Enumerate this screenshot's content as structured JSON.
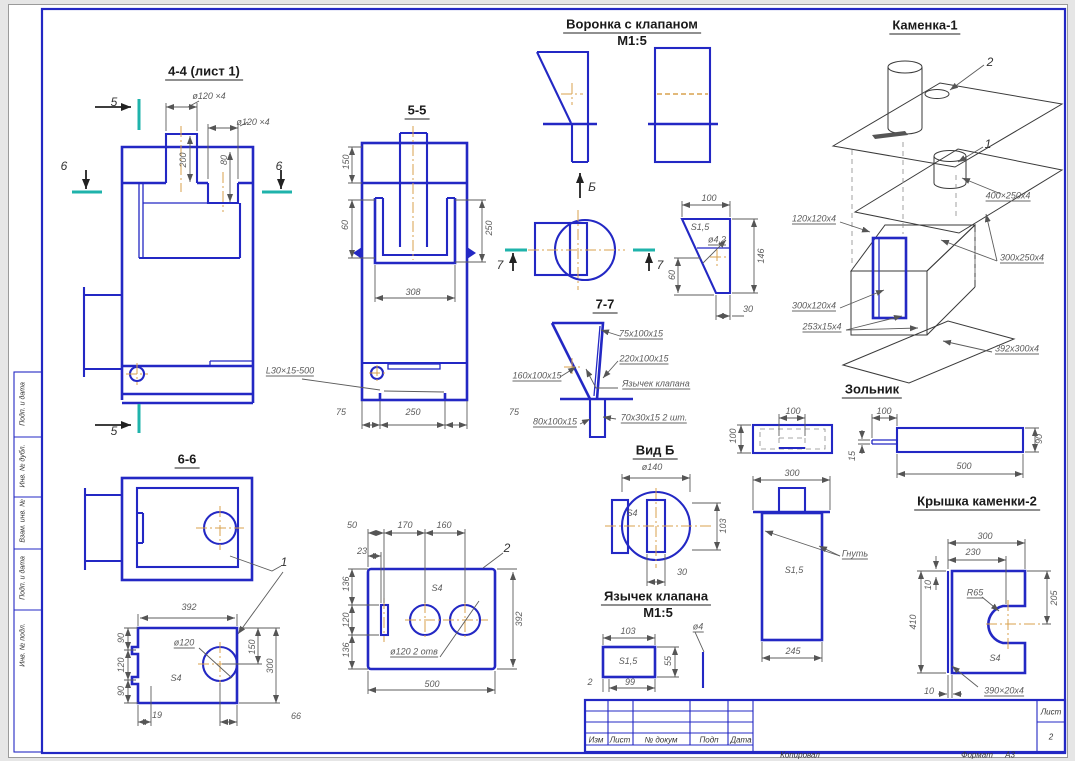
{
  "document_type": "engineering-drawing-sheet",
  "colors": {
    "line_blue": "#2328c4",
    "section_cyan": "#1fb3ab",
    "centerline_orange": "#d8a24e",
    "dim_gray": "#5c5c5c",
    "iso_black": "#3a3a3a",
    "sheet_background": "#ffffff"
  },
  "labels": [
    {
      "id": "title-section-4-4",
      "t": "4-4 (лист 1)",
      "x": 204,
      "y": 72,
      "cls": "title"
    },
    {
      "id": "title-section-5-5",
      "t": "5-5",
      "x": 417,
      "y": 111,
      "cls": "title"
    },
    {
      "id": "title-section-6-6",
      "t": "6-6",
      "x": 187,
      "y": 460,
      "cls": "title"
    },
    {
      "id": "title-section-7-7",
      "t": "7-7",
      "x": 605,
      "y": 305,
      "cls": "title"
    },
    {
      "id": "title-voronka",
      "t": "Воронка с клапаном",
      "x": 632,
      "y": 25,
      "cls": "title"
    },
    {
      "id": "title-voronka-scale",
      "t": "М1:5",
      "x": 632,
      "y": 41,
      "cls": "title nou"
    },
    {
      "id": "title-vid-b",
      "t": "Вид Б",
      "x": 655,
      "y": 451,
      "cls": "title"
    },
    {
      "id": "title-yazychek",
      "t": "Язычек клапана",
      "x": 656,
      "y": 597,
      "cls": "title"
    },
    {
      "id": "title-yazychek-scale",
      "t": "М1:5",
      "x": 658,
      "y": 613,
      "cls": "title nou"
    },
    {
      "id": "title-kamenka-1",
      "t": "Каменка-1",
      "x": 925,
      "y": 26,
      "cls": "title"
    },
    {
      "id": "title-zolnik",
      "t": "Зольник",
      "x": 872,
      "y": 390,
      "cls": "title"
    },
    {
      "id": "title-kryshka-kamenki-2",
      "t": "Крышка каменки-2",
      "x": 977,
      "y": 502,
      "cls": "title"
    },
    {
      "id": "mark-5-top",
      "t": "5",
      "x": 114,
      "y": 102,
      "cls": "mark"
    },
    {
      "id": "mark-5-bottom",
      "t": "5",
      "x": 114,
      "y": 431,
      "cls": "mark"
    },
    {
      "id": "mark-6-left",
      "t": "6",
      "x": 64,
      "y": 166,
      "cls": "mark"
    },
    {
      "id": "mark-6-right",
      "t": "6",
      "x": 279,
      "y": 166,
      "cls": "mark"
    },
    {
      "id": "mark-7-left",
      "t": "7",
      "x": 500,
      "y": 265,
      "cls": "mark"
    },
    {
      "id": "mark-7-right",
      "t": "7",
      "x": 660,
      "y": 265,
      "cls": "mark"
    },
    {
      "id": "mark-view-b-arrow",
      "t": "Б",
      "x": 592,
      "y": 187,
      "cls": "mark"
    },
    {
      "id": "mark-part-1-leader",
      "t": "1",
      "x": 284,
      "y": 562,
      "cls": "mark"
    },
    {
      "id": "mark-part-2-plate",
      "t": "2",
      "x": 507,
      "y": 548,
      "cls": "mark"
    },
    {
      "id": "mark-part-2-kamenka",
      "t": "2",
      "x": 990,
      "y": 62,
      "cls": "mark"
    },
    {
      "id": "mark-part-1-kamenka",
      "t": "1",
      "x": 988,
      "y": 144,
      "cls": "mark"
    },
    {
      "id": "dim-44-d120x4-top",
      "t": "ø120 ×4",
      "x": 209,
      "y": 96,
      "cls": "dim"
    },
    {
      "id": "dim-44-d120x4-right",
      "t": "ø120 ×4",
      "x": 253,
      "y": 122,
      "cls": "dim"
    },
    {
      "id": "dim-44-200",
      "t": "200",
      "x": 183,
      "y": 160,
      "r": 1,
      "cls": "dim"
    },
    {
      "id": "dim-44-80",
      "t": "80",
      "x": 224,
      "y": 160,
      "r": 1,
      "cls": "dim"
    },
    {
      "id": "dim-55-150",
      "t": "150",
      "x": 346,
      "y": 162,
      "r": 1,
      "cls": "dim"
    },
    {
      "id": "dim-55-60",
      "t": "60",
      "x": 345,
      "y": 225,
      "r": 1,
      "cls": "dim"
    },
    {
      "id": "dim-55-250",
      "t": "250",
      "x": 489,
      "y": 228,
      "r": 1,
      "cls": "dim"
    },
    {
      "id": "dim-55-308",
      "t": "308",
      "x": 413,
      "y": 292,
      "cls": "dim"
    },
    {
      "id": "dim-55-75-left",
      "t": "75",
      "x": 341,
      "y": 412,
      "cls": "dim"
    },
    {
      "id": "dim-55-250-bottom",
      "t": "250",
      "x": 413,
      "y": 412,
      "cls": "dim"
    },
    {
      "id": "dim-55-75-right",
      "t": "75",
      "x": 514,
      "y": 412,
      "cls": "dim"
    },
    {
      "id": "lead-55-angle",
      "t": "L30×15-500",
      "x": 290,
      "y": 371,
      "cls": "lead"
    },
    {
      "id": "dim-p1-392",
      "t": "392",
      "x": 189,
      "y": 607,
      "cls": "dim"
    },
    {
      "id": "dim-p1-90-top",
      "t": "90",
      "x": 121,
      "y": 638,
      "r": 1,
      "cls": "dim"
    },
    {
      "id": "dim-p1-120",
      "t": "120",
      "x": 121,
      "y": 665,
      "r": 1,
      "cls": "dim"
    },
    {
      "id": "dim-p1-90-bottom",
      "t": "90",
      "x": 121,
      "y": 691,
      "r": 1,
      "cls": "dim"
    },
    {
      "id": "lead-p1-d120",
      "t": "ø120",
      "x": 184,
      "y": 643,
      "cls": "lead"
    },
    {
      "id": "dim-p1-s4",
      "t": "S4",
      "x": 176,
      "y": 678,
      "cls": "dim"
    },
    {
      "id": "dim-p1-150",
      "t": "150",
      "x": 252,
      "y": 647,
      "r": 1,
      "cls": "dim"
    },
    {
      "id": "dim-p1-300",
      "t": "300",
      "x": 270,
      "y": 666,
      "r": 1,
      "cls": "dim"
    },
    {
      "id": "dim-p1-19",
      "t": "19",
      "x": 157,
      "y": 715,
      "cls": "dim"
    },
    {
      "id": "dim-p1-66",
      "t": "66",
      "x": 296,
      "y": 716,
      "cls": "dim"
    },
    {
      "id": "dim-p2-50",
      "t": "50",
      "x": 352,
      "y": 525,
      "cls": "dim"
    },
    {
      "id": "dim-p2-170",
      "t": "170",
      "x": 405,
      "y": 525,
      "cls": "dim"
    },
    {
      "id": "dim-p2-160",
      "t": "160",
      "x": 444,
      "y": 525,
      "cls": "dim"
    },
    {
      "id": "dim-p2-23",
      "t": "23",
      "x": 362,
      "y": 551,
      "cls": "dim"
    },
    {
      "id": "dim-p2-136-top",
      "t": "136",
      "x": 346,
      "y": 584,
      "r": 1,
      "cls": "dim"
    },
    {
      "id": "dim-p2-120",
      "t": "120",
      "x": 346,
      "y": 620,
      "r": 1,
      "cls": "dim"
    },
    {
      "id": "dim-p2-136-bottom",
      "t": "136",
      "x": 346,
      "y": 650,
      "r": 1,
      "cls": "dim"
    },
    {
      "id": "dim-p2-392",
      "t": "392",
      "x": 519,
      "y": 619,
      "r": 1,
      "cls": "dim"
    },
    {
      "id": "dim-p2-s4",
      "t": "S4",
      "x": 437,
      "y": 588,
      "cls": "dim"
    },
    {
      "id": "lead-p2-d120-2otv",
      "t": "ø120 2 отв",
      "x": 414,
      "y": 652,
      "cls": "lead"
    },
    {
      "id": "dim-p2-500",
      "t": "500",
      "x": 432,
      "y": 684,
      "cls": "dim"
    },
    {
      "id": "dim-tr-100",
      "t": "100",
      "x": 709,
      "y": 198,
      "cls": "dim"
    },
    {
      "id": "dim-tr-s15",
      "t": "S1,5",
      "x": 700,
      "y": 227,
      "cls": "dim"
    },
    {
      "id": "lead-tr-d4-2",
      "t": "ø4,2",
      "x": 717,
      "y": 240,
      "cls": "lead"
    },
    {
      "id": "dim-tr-146",
      "t": "146",
      "x": 761,
      "y": 256,
      "r": 1,
      "cls": "dim"
    },
    {
      "id": "dim-tr-60",
      "t": "60",
      "x": 672,
      "y": 275,
      "r": 1,
      "cls": "dim"
    },
    {
      "id": "dim-tr-30",
      "t": "30",
      "x": 748,
      "y": 309,
      "cls": "dim"
    },
    {
      "id": "lead-77-75x100",
      "t": "75х100х15",
      "x": 641,
      "y": 334,
      "cls": "lead"
    },
    {
      "id": "lead-77-220x100",
      "t": "220х100х15",
      "x": 644,
      "y": 359,
      "cls": "lead"
    },
    {
      "id": "lead-77-160x100",
      "t": "160х100х15",
      "x": 537,
      "y": 376,
      "cls": "lead"
    },
    {
      "id": "lead-77-tongue",
      "t": "Язычек клапана",
      "x": 656,
      "y": 384,
      "cls": "lead"
    },
    {
      "id": "lead-77-80x100",
      "t": "80х100х15",
      "x": 555,
      "y": 422,
      "cls": "lead"
    },
    {
      "id": "lead-77-70x30",
      "t": "70х30х15 2 шт.",
      "x": 654,
      "y": 418,
      "cls": "lead"
    },
    {
      "id": "dim-vb-d140",
      "t": "ø140",
      "x": 652,
      "y": 467,
      "cls": "dim"
    },
    {
      "id": "dim-vb-s4",
      "t": "S4",
      "x": 632,
      "y": 513,
      "cls": "dim"
    },
    {
      "id": "dim-vb-103",
      "t": "103",
      "x": 723,
      "y": 526,
      "r": 1,
      "cls": "dim"
    },
    {
      "id": "dim-vb-30",
      "t": "30",
      "x": 682,
      "y": 572,
      "cls": "dim"
    },
    {
      "id": "dim-ya-103",
      "t": "103",
      "x": 628,
      "y": 631,
      "cls": "dim"
    },
    {
      "id": "dim-ya-s15",
      "t": "S1,5",
      "x": 628,
      "y": 661,
      "cls": "dim"
    },
    {
      "id": "dim-ya-55",
      "t": "55",
      "x": 668,
      "y": 661,
      "r": 1,
      "cls": "dim"
    },
    {
      "id": "dim-ya-99",
      "t": "99",
      "x": 630,
      "y": 682,
      "cls": "dim"
    },
    {
      "id": "dim-ya-2",
      "t": "2",
      "x": 590,
      "y": 682,
      "cls": "dim"
    },
    {
      "id": "lead-ya-d4",
      "t": "ø4",
      "x": 698,
      "y": 627,
      "cls": "lead"
    },
    {
      "id": "lead-k1-400x250",
      "t": "400×250х4",
      "x": 1008,
      "y": 196,
      "cls": "lead"
    },
    {
      "id": "lead-k1-120x120",
      "t": "120х120х4",
      "x": 814,
      "y": 219,
      "cls": "lead"
    },
    {
      "id": "lead-k1-300x250",
      "t": "300х250х4",
      "x": 1022,
      "y": 258,
      "cls": "lead"
    },
    {
      "id": "lead-k1-300x120",
      "t": "300х120х4",
      "x": 814,
      "y": 306,
      "cls": "lead"
    },
    {
      "id": "lead-k1-253x15",
      "t": "253х15х4",
      "x": 822,
      "y": 327,
      "cls": "lead"
    },
    {
      "id": "lead-k1-392x300",
      "t": "392х300х4",
      "x": 1017,
      "y": 349,
      "cls": "lead"
    },
    {
      "id": "dim-z-100-slot",
      "t": "100",
      "x": 793,
      "y": 411,
      "cls": "dim"
    },
    {
      "id": "dim-z-100-left",
      "t": "100",
      "x": 733,
      "y": 436,
      "r": 1,
      "cls": "dim"
    },
    {
      "id": "dim-z-100-handle",
      "t": "100",
      "x": 884,
      "y": 411,
      "cls": "dim"
    },
    {
      "id": "dim-z-15",
      "t": "15",
      "x": 852,
      "y": 456,
      "r": 1,
      "cls": "dim"
    },
    {
      "id": "dim-z-500",
      "t": "500",
      "x": 964,
      "y": 466,
      "cls": "dim"
    },
    {
      "id": "dim-z-90",
      "t": "90",
      "x": 1039,
      "y": 439,
      "r": 1,
      "cls": "dim"
    },
    {
      "id": "dim-pan-300",
      "t": "300",
      "x": 792,
      "y": 473,
      "cls": "dim"
    },
    {
      "id": "lead-pan-gnut",
      "t": "Гнуть",
      "x": 855,
      "y": 554,
      "cls": "lead"
    },
    {
      "id": "dim-pan-s15",
      "t": "S1,5",
      "x": 794,
      "y": 570,
      "cls": "dim"
    },
    {
      "id": "dim-pan-245",
      "t": "245",
      "x": 793,
      "y": 651,
      "cls": "dim"
    },
    {
      "id": "dim-kr-300",
      "t": "300",
      "x": 985,
      "y": 536,
      "cls": "dim"
    },
    {
      "id": "dim-kr-230",
      "t": "230",
      "x": 973,
      "y": 552,
      "cls": "dim"
    },
    {
      "id": "dim-kr-10-top",
      "t": "10",
      "x": 928,
      "y": 585,
      "r": 1,
      "cls": "dim"
    },
    {
      "id": "dim-kr-410",
      "t": "410",
      "x": 913,
      "y": 622,
      "r": 1,
      "cls": "dim"
    },
    {
      "id": "lead-kr-r65",
      "t": "R65",
      "x": 975,
      "y": 593,
      "cls": "lead"
    },
    {
      "id": "dim-kr-205",
      "t": "205",
      "x": 1054,
      "y": 598,
      "r": 1,
      "cls": "dim"
    },
    {
      "id": "dim-kr-s4",
      "t": "S4",
      "x": 995,
      "y": 658,
      "cls": "dim"
    },
    {
      "id": "dim-kr-10-bottom",
      "t": "10",
      "x": 929,
      "y": 691,
      "cls": "dim"
    },
    {
      "id": "lead-kr-390x20",
      "t": "390×20х4",
      "x": 1004,
      "y": 691,
      "cls": "lead"
    },
    {
      "id": "tb-col-izm",
      "t": "Изм",
      "x": 596,
      "y": 740,
      "cls": "tb"
    },
    {
      "id": "tb-col-list",
      "t": "Лист",
      "x": 620,
      "y": 740,
      "cls": "tb"
    },
    {
      "id": "tb-col-ndokum",
      "t": "№ докум",
      "x": 661,
      "y": 740,
      "cls": "tb"
    },
    {
      "id": "tb-col-podp",
      "t": "Подп",
      "x": 709,
      "y": 740,
      "cls": "tb"
    },
    {
      "id": "tb-col-data",
      "t": "Дата",
      "x": 741,
      "y": 740,
      "cls": "tb"
    },
    {
      "id": "tb-list-header",
      "t": "Лист",
      "x": 1051,
      "y": 712,
      "cls": "tb"
    },
    {
      "id": "tb-sheet-number",
      "t": "2",
      "x": 1051,
      "y": 737,
      "cls": "tb"
    },
    {
      "id": "tb-kopiroval",
      "t": "Копировал",
      "x": 800,
      "y": 755,
      "cls": "tb"
    },
    {
      "id": "tb-format-label",
      "t": "Формат",
      "x": 977,
      "y": 755,
      "cls": "tb"
    },
    {
      "id": "tb-format-value",
      "t": "А3",
      "x": 1010,
      "y": 755,
      "cls": "tb"
    },
    {
      "id": "strip-podp-i-data-1",
      "t": "Подп. и дата",
      "x": 23,
      "y": 404,
      "r": 1,
      "cls": "strip"
    },
    {
      "id": "strip-inv-n-dubl",
      "t": "Инв. № дубл.",
      "x": 23,
      "y": 466,
      "r": 1,
      "cls": "strip"
    },
    {
      "id": "strip-vzam-inv-n",
      "t": "Взам. инв. №",
      "x": 23,
      "y": 521,
      "r": 1,
      "cls": "strip"
    },
    {
      "id": "strip-podp-i-data-2",
      "t": "Подп. и дата",
      "x": 23,
      "y": 578,
      "r": 1,
      "cls": "strip"
    },
    {
      "id": "strip-inv-n-podl",
      "t": "Инв. № подл.",
      "x": 23,
      "y": 645,
      "r": 1,
      "cls": "strip"
    }
  ]
}
